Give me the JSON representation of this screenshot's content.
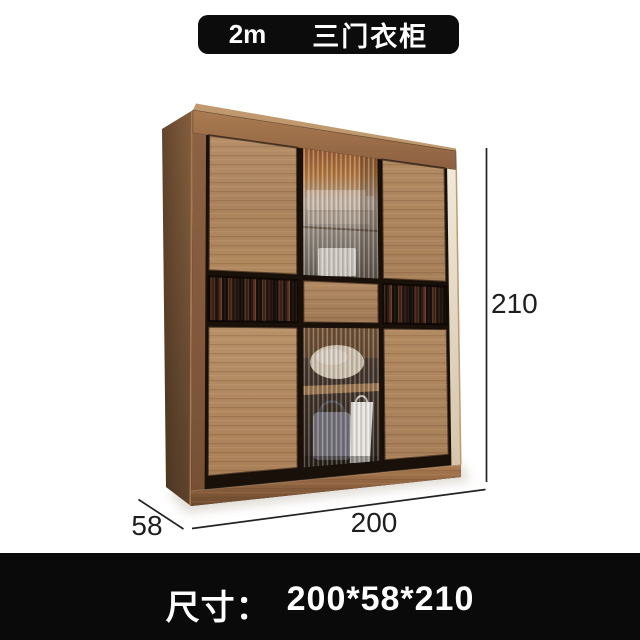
{
  "title_banner": {
    "size_tag": "2m",
    "product_name": "三门衣柜"
  },
  "size_banner": {
    "label": "尺寸：",
    "value": "200*58*210"
  },
  "dimensions": {
    "height": "210",
    "width": "200",
    "depth": "58"
  },
  "palette": {
    "background": "#ffffff",
    "banner_bg": "#0c0c0c",
    "banner_text": "#ffffff",
    "dimension_line": "#232323",
    "frame_wood": "#9a6c48",
    "door_wood": "#b28b64",
    "side_panel_wood": "#6f4e33",
    "glass_interior_amber": "#a3602f",
    "dark_tinted_glass": "#1c120c",
    "plinth_wood": "#8a5f3d",
    "right_edge_highlight": "#eee4d3"
  }
}
